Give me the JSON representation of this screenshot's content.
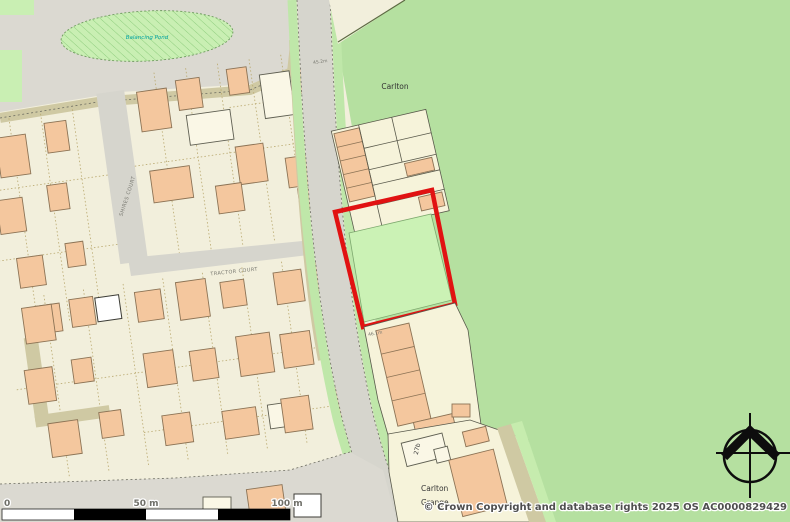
{
  "map": {
    "place_labels": {
      "pond": "Balancing Pond",
      "district": "Carlton",
      "grange_line1": "Carlton",
      "grange_line2": "Grange"
    },
    "street_labels": {
      "tractor_court": "TRACTOR COURT",
      "side_street": "SHIRES COURT"
    },
    "building_labels": {
      "plot_27b": "27b"
    },
    "spot_heights": {
      "road_north": "45.2m",
      "road_mid": "46.1m"
    },
    "scale_bar": {
      "zero": "0",
      "fifty": "50 m",
      "hundred": "100 m"
    },
    "attribution": "© Crown Copyright and database rights 2025 OS AC0000829429",
    "colors": {
      "field_green": "#b5e0a0",
      "site_plot_green": "#cbf2b5",
      "verge_green": "#bfe7a9",
      "road_grey": "#d6d5cd",
      "open_land_grey": "#dbd9d1",
      "estate_cream": "#f2efdc",
      "building_orange": "#f4c79e",
      "hedge_khaki": "#cfc9a3",
      "red_site_boundary": "#e11212",
      "water_text_teal": "#00a3a3"
    }
  }
}
